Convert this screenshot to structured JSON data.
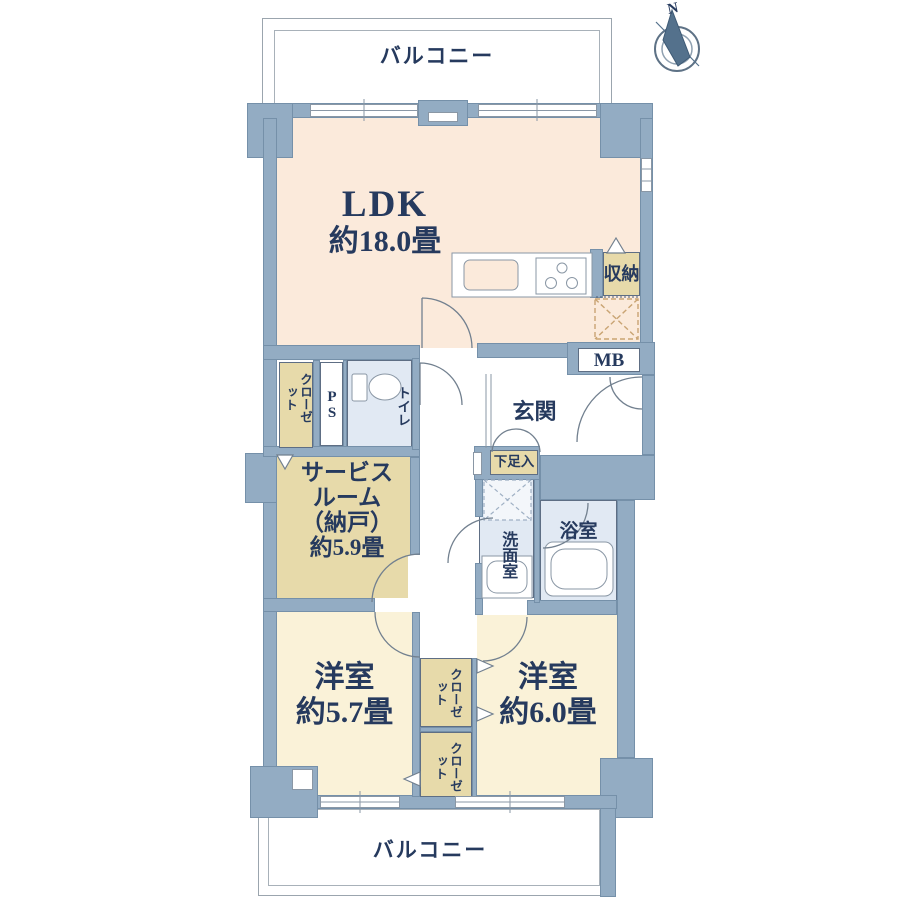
{
  "floorplan": {
    "compass_label": "N",
    "balcony_top": "バルコニー",
    "balcony_bottom": "バルコニー",
    "ldk": {
      "name": "LDK",
      "size": "約18.0畳"
    },
    "service_room": {
      "line1": "サービス",
      "line2": "ルーム",
      "line3": "（納戸）",
      "line4": "約5.9畳"
    },
    "bedroom_left": {
      "name": "洋室",
      "size": "約5.7畳"
    },
    "bedroom_right": {
      "name": "洋室",
      "size": "約6.0畳"
    },
    "labels": {
      "toilet": "トイレ",
      "pipe_space": "PS",
      "closet": "クローゼット",
      "storage": "収納",
      "meter_box": "MB",
      "entrance": "玄関",
      "shoe_cabinet": "下足入",
      "washroom": "洗面室",
      "bathroom": "浴室"
    },
    "colors": {
      "wall": "#93ACC3",
      "ldk_floor": "#FBEADB",
      "bedroom_floor": "#FAF2D8",
      "storage_floor": "#E7DAAA",
      "wet_floor": "#E1E9F3",
      "text": "#263A5E"
    }
  }
}
